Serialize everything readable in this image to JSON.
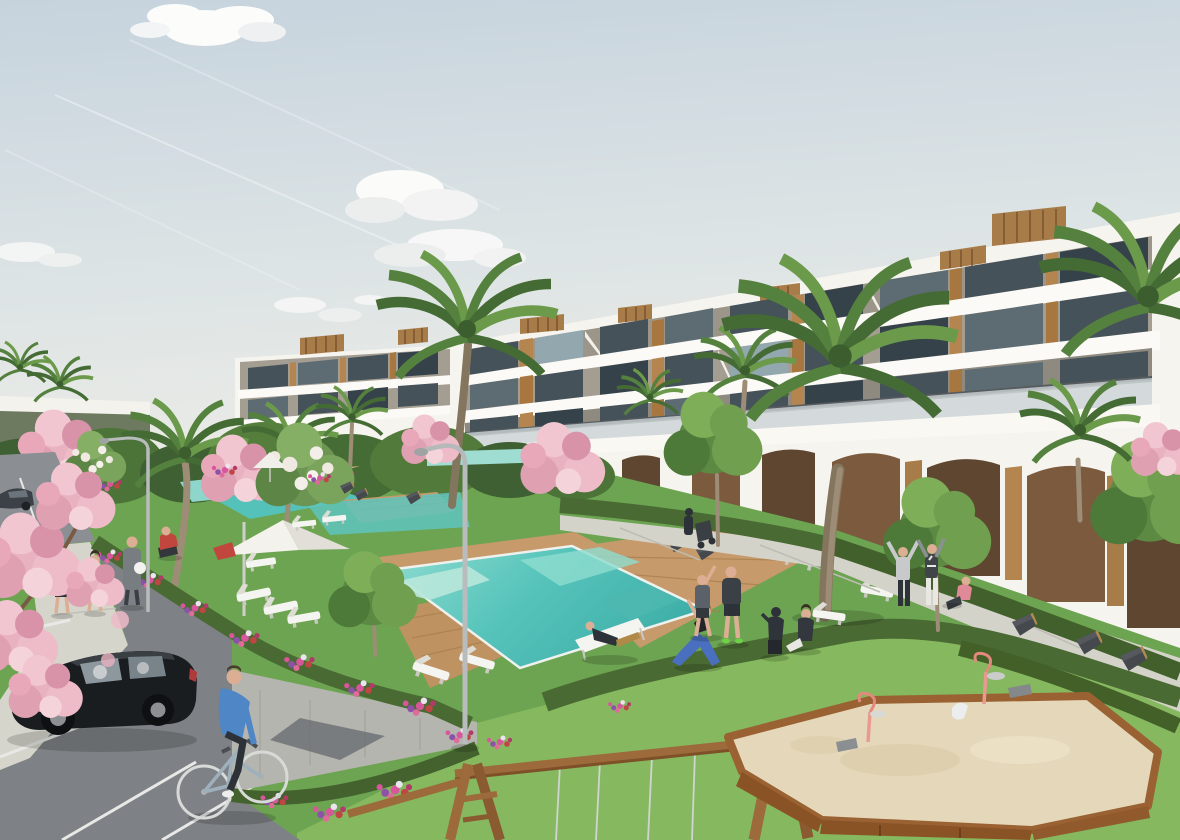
{
  "meta": {
    "type": "3d-architectural-render",
    "subject": "Mediterranean apartment complex with communal pools, lawns, parking and playground",
    "width_px": 1180,
    "height_px": 840
  },
  "palette": {
    "sky_top": "#c6d3dd",
    "sky_mid": "#dde4e5",
    "sky_horizon": "#efede6",
    "cloud": "#fcfcfb",
    "facade": "#f6f4ee",
    "facade_shadow": "#9c968a",
    "glass": "#46525a",
    "wood": "#b5854f",
    "roof_wood": "#a87c48",
    "grass_upper": "#6da451",
    "grass_fore": "#86b95f",
    "hedge": "#4a6a33",
    "flower_pink": "#d8579c",
    "flower_red": "#c04545",
    "flower_purple": "#8d52a8",
    "blossom_pink": "#e9b2c1",
    "pool": "#55c2b9",
    "pool_light": "#b9e7da",
    "deck": "#c69a6a",
    "path": "#d4d3ca",
    "paver": "#b4b5ae",
    "asphalt": "#7e8185",
    "sand": "#e5d8ba",
    "car_body": "#1a1d20",
    "cyclist_jersey": "#4f86c6",
    "lamp": "#b9bcbc",
    "bench": "#45494d",
    "swing_wood": "#9c6a3b",
    "toy_pink": "#e89a90"
  },
  "scene": {
    "sky": {
      "clouds": [
        "large cumulus top-left",
        "cloud bank centre-right",
        "small puffs lower-left",
        "small puffs centre"
      ],
      "contrails": 3
    },
    "architecture": {
      "description": "Long terraced white apartment block rising toward the right, wood-panel accents, dark glazing, glass balustrades, rooftop timber pergola boxes, arched ground-floor arcade",
      "floors": 4,
      "rooftop_boxes": 7,
      "arcade_arches": 8
    },
    "landscape": {
      "pools": 4,
      "parasols": 3,
      "sun_loungers": 12,
      "palm_trees": 10,
      "blossom_trees": 6,
      "street_lamps": 2,
      "benches": 8,
      "flower_beds": 6,
      "hedges": "clipped hedges lining paths and lawns"
    },
    "playground": {
      "sandbox": "timber-framed sandpit with two pink spring riders and toys",
      "swing_set": "timber A-frame swing with four rope swings"
    },
    "people": [
      {
        "label": "cyclist in blue crossing the car park"
      },
      {
        "label": "two women walking on the footpath"
      },
      {
        "label": "man in grey carrying a white ball"
      },
      {
        "label": "person in red tending flowers"
      },
      {
        "label": "person pushing a stroller by the arcade"
      },
      {
        "label": "man reclining on a sun lounger"
      },
      {
        "label": "woman doing a lunge stretch"
      },
      {
        "label": "man stretching with raised arm"
      },
      {
        "label": "man in dark sportswear"
      },
      {
        "label": "person crouching taking a photo"
      },
      {
        "label": "woman sitting on the lawn"
      },
      {
        "label": "two people stretching beside the arcade"
      },
      {
        "label": "woman in pink sitting on the path"
      }
    ],
    "vehicles": [
      {
        "label": "black hatchback parked in bay"
      },
      {
        "label": "dark car at street edge"
      },
      {
        "label": "bicycle"
      }
    ]
  }
}
